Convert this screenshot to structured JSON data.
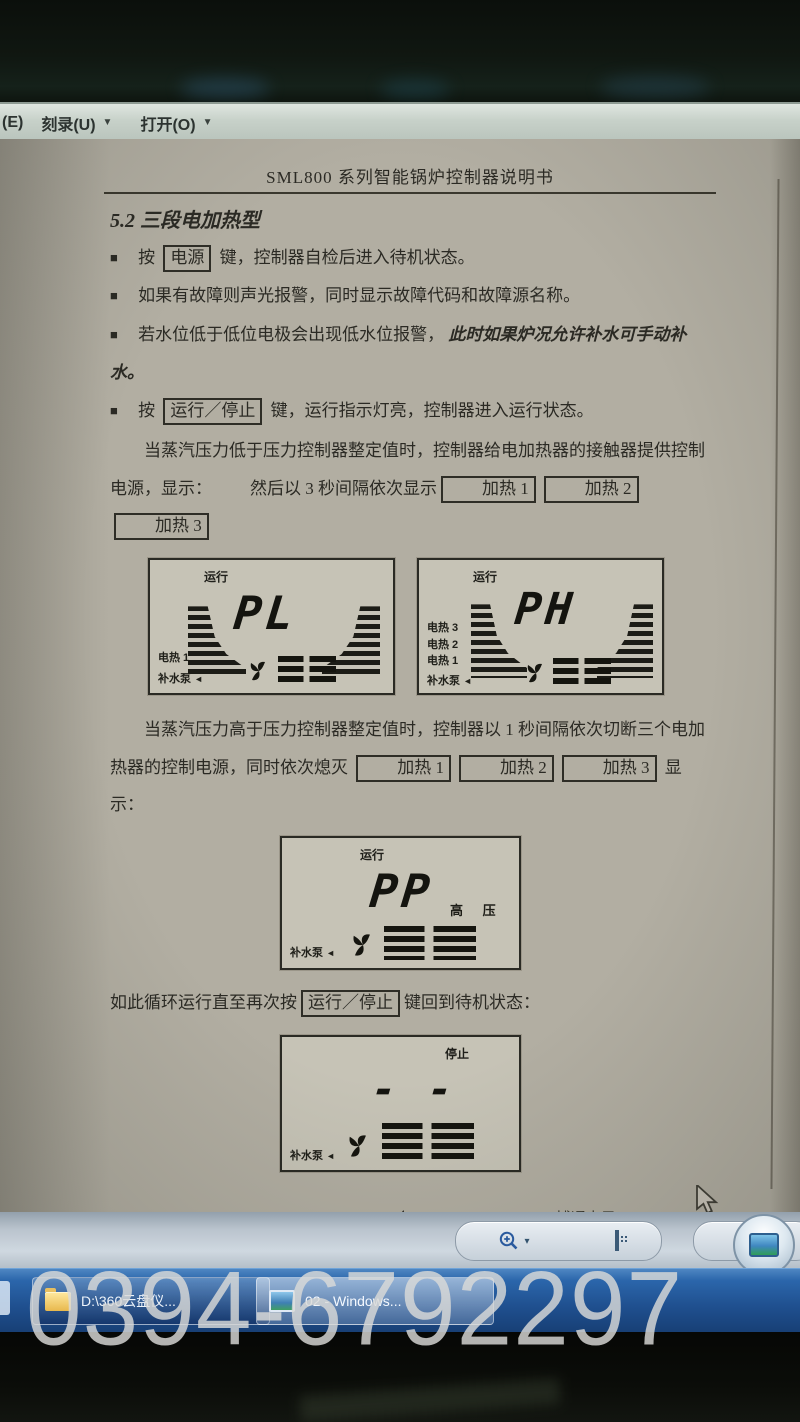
{
  "colors": {
    "taskbar_blue": "#2b66ab",
    "page_paper": "#b2aea2",
    "menubar_gray": "#c7d1c9",
    "watermark_gray": "#dadad8",
    "ink": "#2b2a24"
  },
  "icons": {
    "bullet": "■",
    "menu_caret": "▼",
    "toolbar_caret": "▾",
    "pump_pointer": "◄"
  },
  "window": {
    "menu_partial": "(E)",
    "menu_burn": "刻录(U)",
    "menu_open": "打开(O)"
  },
  "doc": {
    "title": "SML800 系列智能锅炉控制器说明书",
    "section": "5.2 三段电加热型",
    "bullet1_pre": "按",
    "bullet1_key": "电源",
    "bullet1_post": "键，控制器自检后进入待机状态。",
    "bullet2": "如果有故障则声光报警，同时显示故障代码和故障源名称。",
    "bullet3_pre": "若水位低于低位电极会出现低水位报警，",
    "bullet3_italic": "此时如果炉况允许补水可手动补水。",
    "bullet4_pre": "按",
    "bullet4_key": "运行／停止",
    "bullet4_post": "键，运行指示灯亮，控制器进入运行状态。",
    "para1": "当蒸汽压力低于压力控制器整定值时，控制器给电加热器的接触器提供控制电源，显示：",
    "para1b": "然后以 3 秒间隔依次显示",
    "heat_keys": [
      "加热 1",
      "加热 2",
      "加热 3"
    ],
    "para2_pre": "当蒸汽压力高于压力控制器整定值时，控制器以 1 秒间隔依次切断三个电加热器的控制电源，同时依次熄灭",
    "para2_post": "显示：",
    "loop_pre": "如此循环运行直至再次按",
    "loop_key": "运行／停止",
    "loop_post": "键回到待机状态：",
    "footer": {
      "page": "4",
      "company": "博通电子",
      "tel": "Tel：0514-86822181",
      "url": "http://www.yzbtdz.com"
    }
  },
  "lcds": {
    "pl": {
      "status": "运行",
      "value": "PL",
      "heat1": "电热 1",
      "pump": "补水泵"
    },
    "ph": {
      "status": "运行",
      "value": "PH",
      "heat3": "电热 3",
      "heat2": "电热 2",
      "heat1": "电热 1",
      "pump": "补水泵"
    },
    "pp": {
      "status": "运行",
      "value": "PP",
      "side": "高  压",
      "pump": "补水泵"
    },
    "stop": {
      "status": "停止",
      "value": "- -",
      "pump": "补水泵"
    }
  },
  "taskbar": {
    "button1": "D:\\360云盘仪...",
    "button2": "02 - Windows..."
  },
  "watermark": "0394-6792297"
}
